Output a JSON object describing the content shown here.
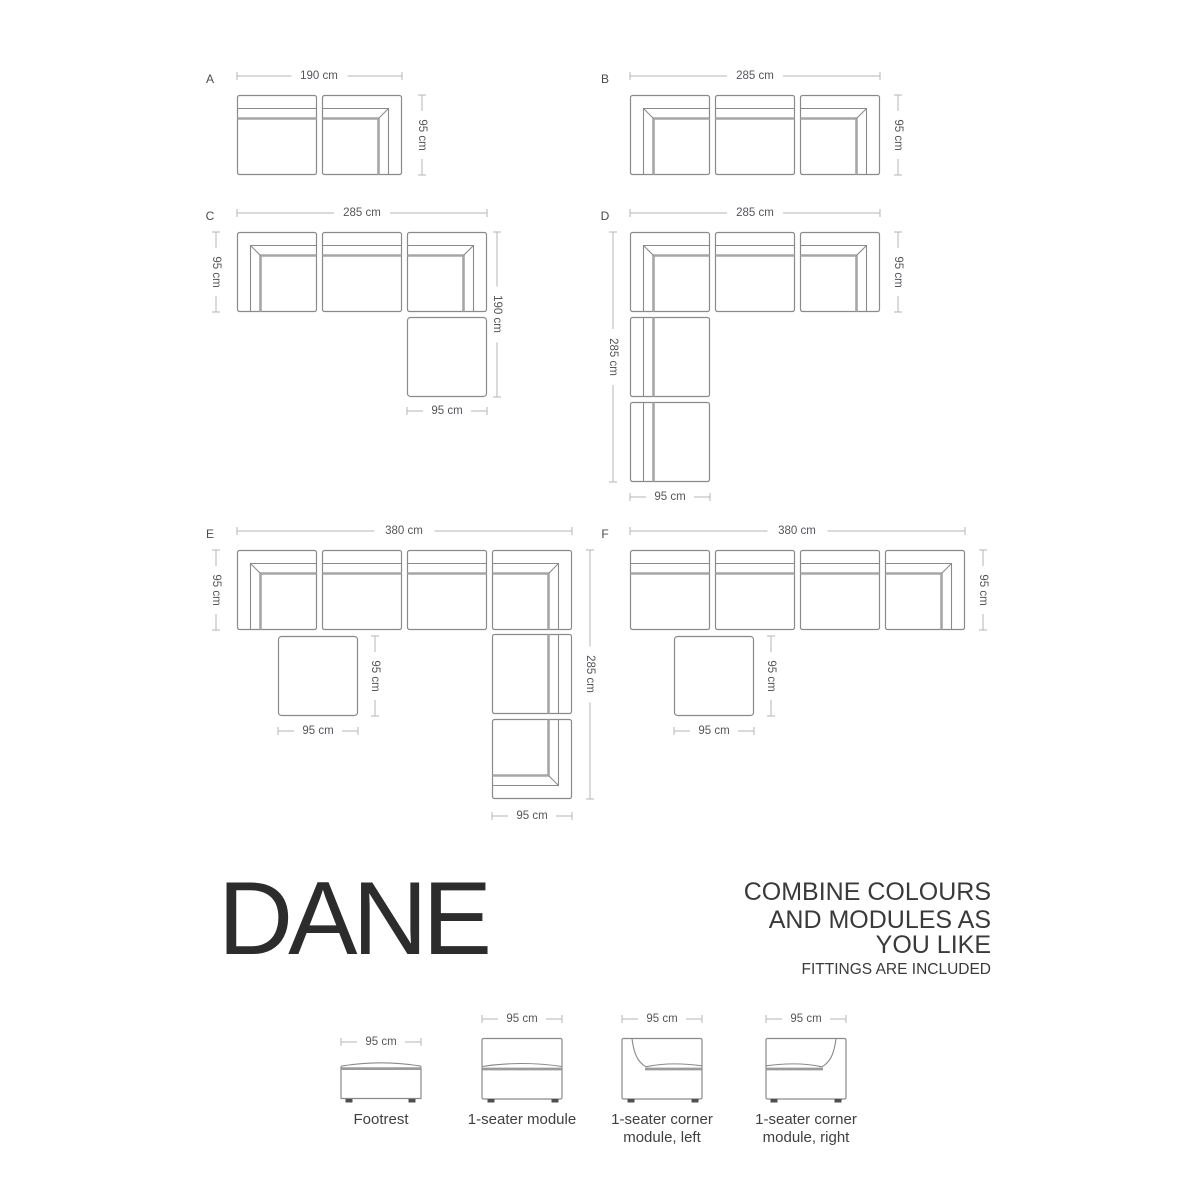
{
  "branding": {
    "title": "DANE",
    "tagline_line1": "COMBINE COLOURS",
    "tagline_line2": "AND MODULES AS",
    "tagline_line3": "YOU LIKE",
    "note": "FITTINGS ARE INCLUDED"
  },
  "configs": {
    "A": {
      "label": "A",
      "top": "190 cm",
      "right": "95 cm"
    },
    "B": {
      "label": "B",
      "top": "285 cm",
      "right": "95 cm"
    },
    "C": {
      "label": "C",
      "top": "285 cm",
      "left": "95 cm",
      "right": "190 cm",
      "bottom": "95 cm"
    },
    "D": {
      "label": "D",
      "top": "285 cm",
      "left": "285 cm",
      "right": "95 cm",
      "bottom": "95 cm"
    },
    "E": {
      "label": "E",
      "top": "380 cm",
      "left": "95 cm",
      "right": "285 cm",
      "footrest_side": "95 cm",
      "footrest_bottom": "95 cm",
      "right_bottom": "95 cm"
    },
    "F": {
      "label": "F",
      "top": "380 cm",
      "right": "95 cm",
      "footrest_side": "95 cm",
      "footrest_bottom": "95 cm"
    }
  },
  "legend": {
    "footrest": {
      "dim": "95 cm",
      "name": "Footrest"
    },
    "seater": {
      "dim": "95 cm",
      "name": "1-seater module"
    },
    "corner_left": {
      "dim": "95 cm",
      "name_line1": "1-seater corner",
      "name_line2": "module, left"
    },
    "corner_right": {
      "dim": "95 cm",
      "name_line1": "1-seater corner",
      "name_line2": "module, right"
    }
  },
  "colors": {
    "outline": "#8a8a8a",
    "cushion_line": "#a6a6a6",
    "dim_line": "#b6b6b6",
    "dim_text": "#55565a",
    "title_text": "#2c2c2c",
    "body_text": "#3a3a3a"
  }
}
